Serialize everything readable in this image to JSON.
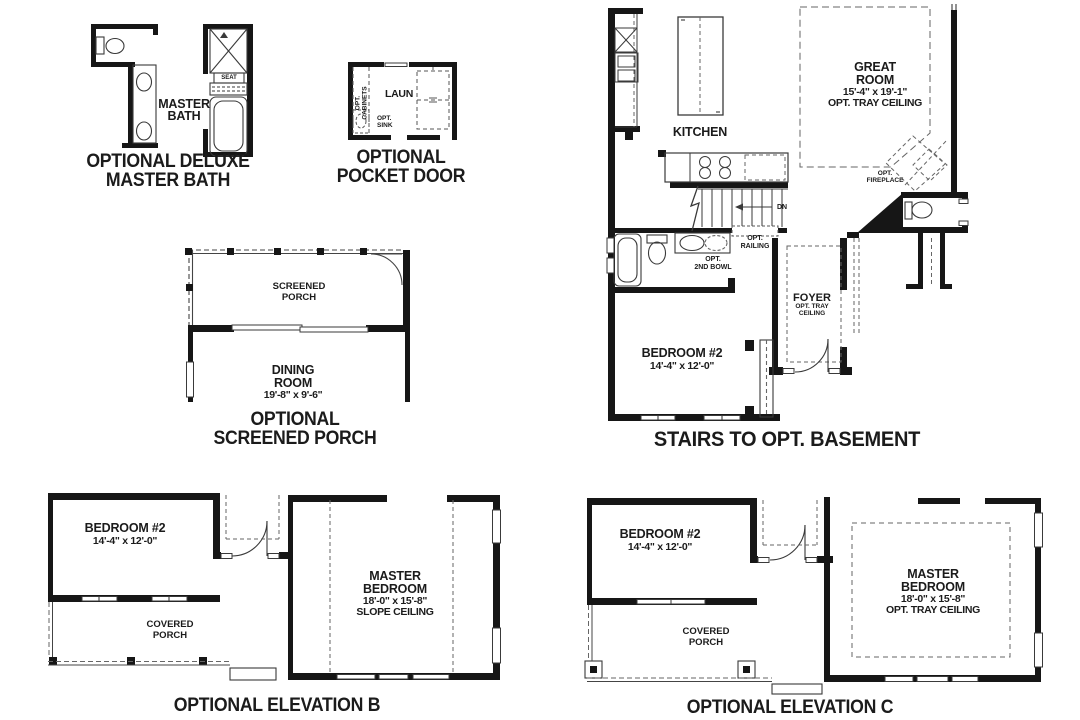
{
  "sheet": {
    "bg": "#ffffff",
    "ink": "#1a1a1a"
  },
  "deluxe_master_bath": {
    "room_line1": "MASTER",
    "room_line2": "BATH",
    "seat": "SEAT",
    "caption_line1": "OPTIONAL DELUXE",
    "caption_line2": "MASTER BATH"
  },
  "pocket_door": {
    "cabinets_line1": "OPT.",
    "cabinets_line2": "CABINETS",
    "laundry": "LAUN",
    "sink_line1": "OPT.",
    "sink_line2": "SINK",
    "caption_line1": "OPTIONAL",
    "caption_line2": "POCKET DOOR"
  },
  "screened_porch": {
    "porch_line1": "SCREENED",
    "porch_line2": "PORCH",
    "dining_line1": "DINING",
    "dining_line2": "ROOM",
    "dining_dims": "19'-8\" x 9'-6\"",
    "caption_line1": "OPTIONAL",
    "caption_line2": "SCREENED PORCH"
  },
  "main_plan": {
    "kitchen": "KITCHEN",
    "great_room_line1": "GREAT",
    "great_room_line2": "ROOM",
    "great_room_dims": "15'-4\" x 19'-1\"",
    "great_room_note": "OPT. TRAY CEILING",
    "fireplace_line1": "OPT.",
    "fireplace_line2": "FIREPLACE",
    "down": "DN",
    "railing_line1": "OPT.",
    "railing_line2": "RAILING",
    "second_bowl_line1": "OPT.",
    "second_bowl_line2": "2ND BOWL",
    "foyer": "FOYER",
    "foyer_note_line1": "OPT. TRAY",
    "foyer_note_line2": "CEILING",
    "bedroom2": "BEDROOM #2",
    "bedroom2_dims": "14'-4\" x 12'-0\"",
    "caption": "STAIRS TO OPT. BASEMENT"
  },
  "elevation_b": {
    "bedroom2": "BEDROOM #2",
    "bedroom2_dims": "14'-4\" x 12'-0\"",
    "porch_line1": "COVERED",
    "porch_line2": "PORCH",
    "master_line1": "MASTER",
    "master_line2": "BEDROOM",
    "master_dims": "18'-0\" x 15'-8\"",
    "master_note": "SLOPE CEILING",
    "caption": "OPTIONAL ELEVATION B"
  },
  "elevation_c": {
    "bedroom2": "BEDROOM #2",
    "bedroom2_dims": "14'-4\" x 12'-0\"",
    "porch_line1": "COVERED",
    "porch_line2": "PORCH",
    "master_line1": "MASTER",
    "master_line2": "BEDROOM",
    "master_dims": "18'-0\" x 15'-8\"",
    "master_note": "OPT. TRAY CEILING",
    "caption": "OPTIONAL ELEVATION C"
  }
}
